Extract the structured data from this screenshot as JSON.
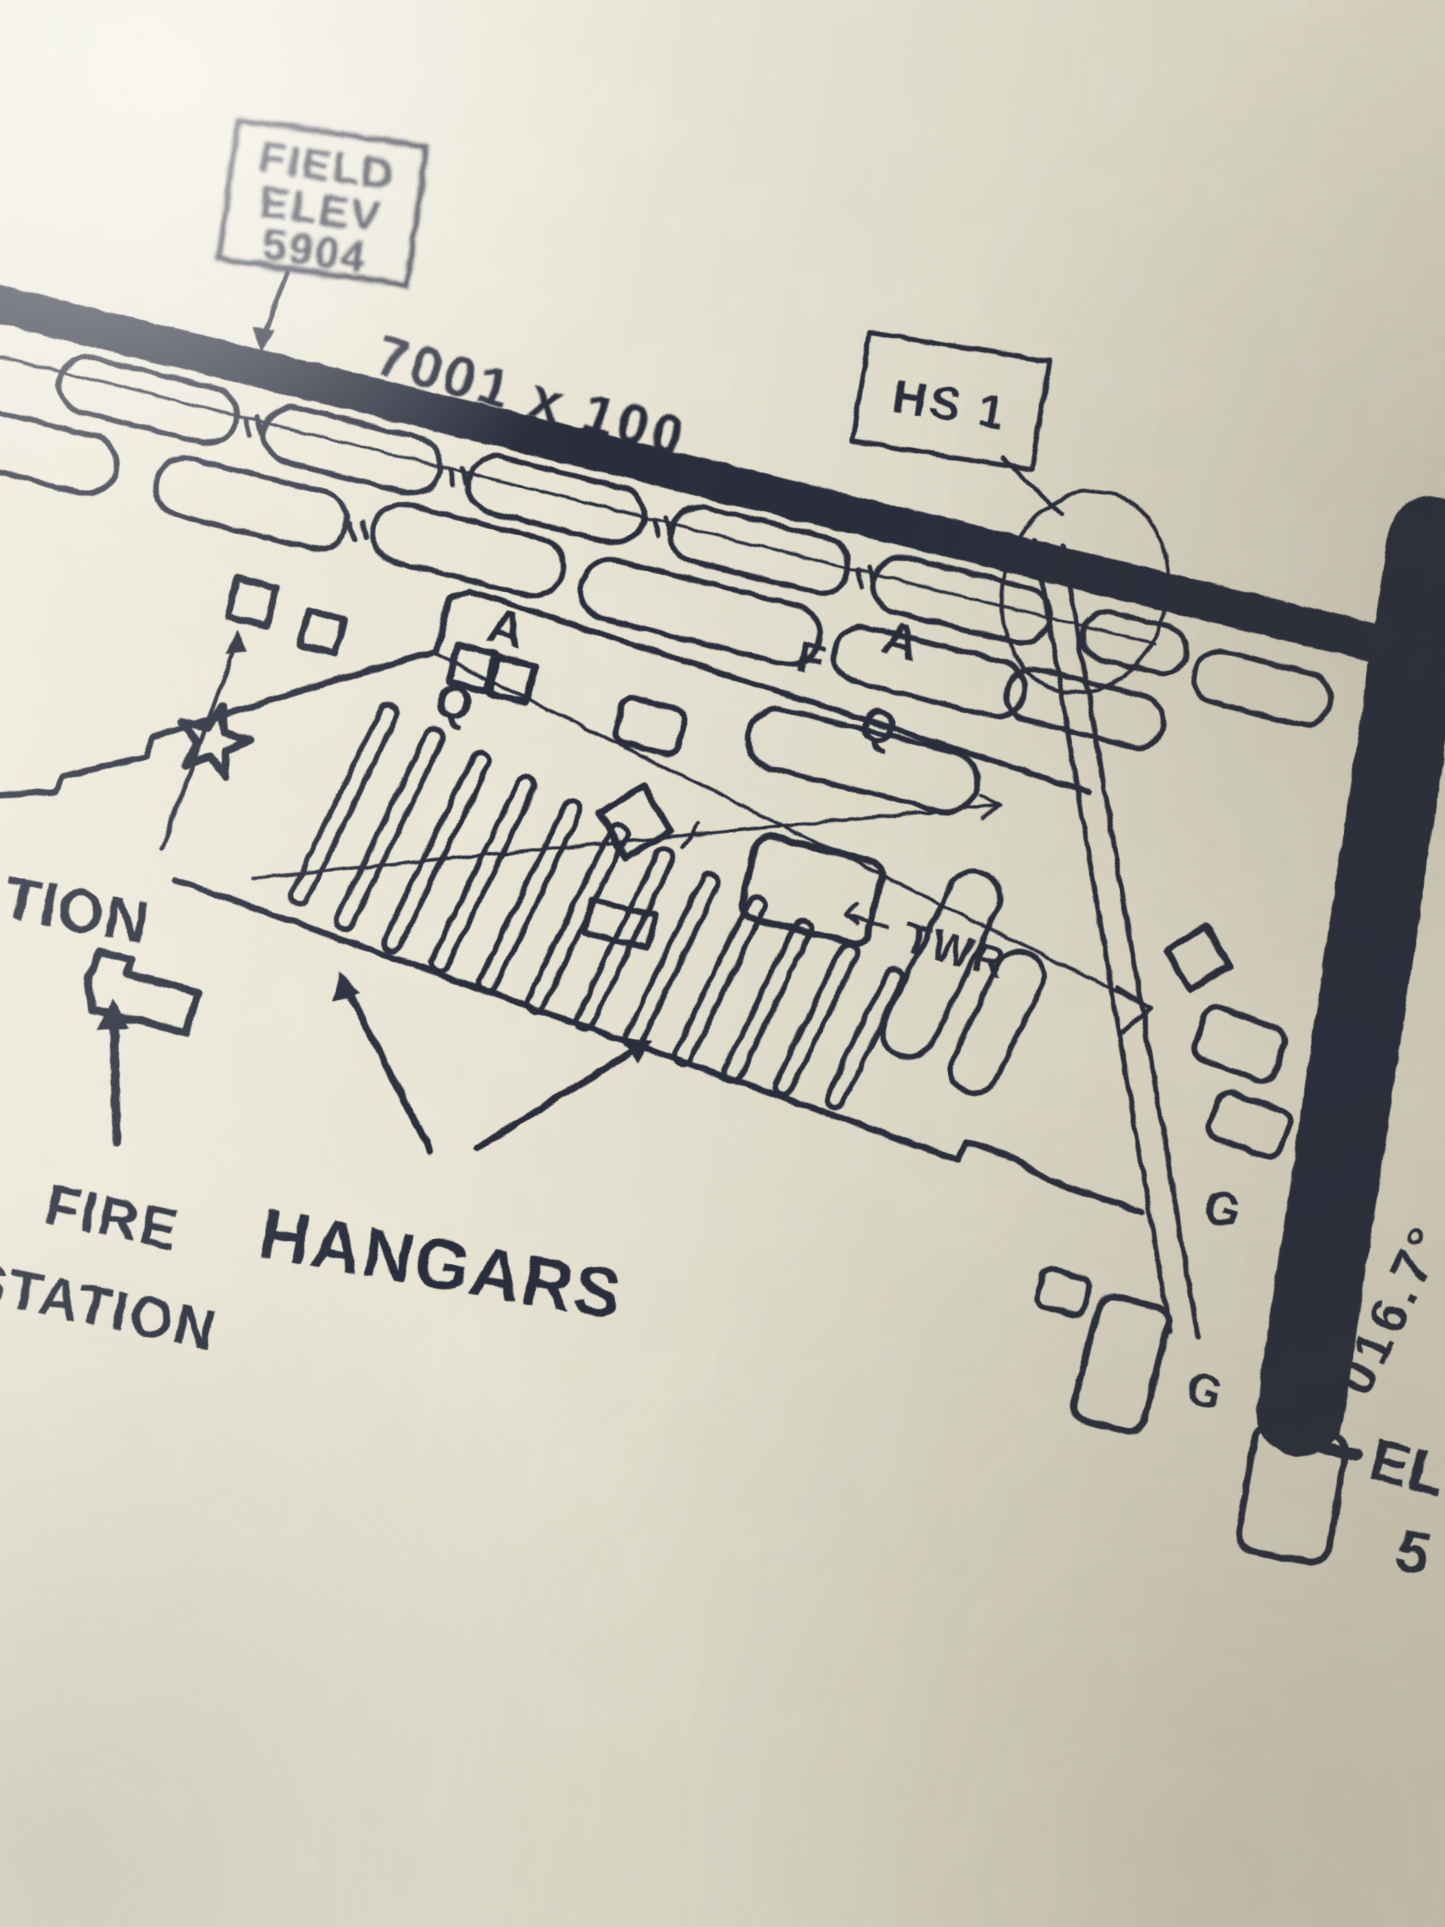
{
  "photo": {
    "description": "close-up photo of a printed airport taxiway diagram on fibrous cream paper",
    "paper_color": "#e9e4d2",
    "ink_color": "#2a2f3e"
  },
  "field_elevation_box": {
    "line1": "FIELD",
    "line2": "ELEV",
    "line3": "5904"
  },
  "runway_main": {
    "dimension": "7001 x 100"
  },
  "runway_crossing": {
    "heading": "016.7°",
    "elevation_partial": {
      "line1": "EL",
      "line2": "5"
    }
  },
  "hot_spot": {
    "label": "HS 1"
  },
  "taxiway_labels": {
    "alpha_west": "A",
    "quebec_west": "Q",
    "foxtrot": "F",
    "alpha_east": "A",
    "quebec_east": "Q",
    "golf_upper": "G",
    "golf_lower": "G"
  },
  "tower_label": "TWR",
  "station_label_partial": "TION",
  "fire_station": {
    "line1": "FIRE",
    "line2": "STATION"
  },
  "hangars_label": "HANGARS",
  "hangar_count": 12,
  "symbols": {
    "beacon": "airport-beacon-star",
    "hot_spot_circle": "hot-spot-circle",
    "tower_building": "diamond-building",
    "fire_station_arrow": "thick-up-arrow",
    "hangars_arrows": "two-up-arrows"
  }
}
